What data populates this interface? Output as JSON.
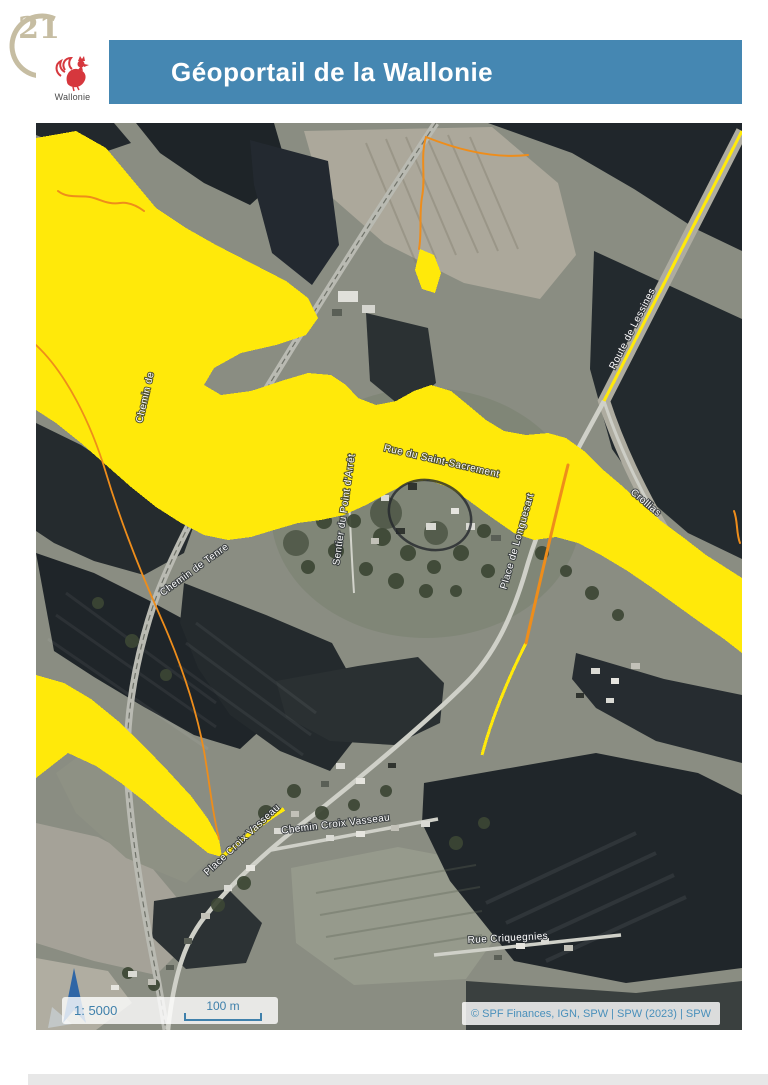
{
  "page": {
    "stamp_number": "21"
  },
  "header": {
    "title": "Géoportail de la Wallonie",
    "logo_text": "Wallonie"
  },
  "map": {
    "scale_text": "1: 5000",
    "scale_bar_label": "100 m",
    "attribution": "© SPF Finances, IGN, SPW | SPW (2023) | SPW",
    "street_labels": [
      {
        "text": "Route de Lessines",
        "x": 599,
        "y": 207,
        "rotate": -63
      },
      {
        "text": "Crollias",
        "x": 608,
        "y": 382,
        "rotate": 40
      },
      {
        "text": "Rue du Saint-Sacrement",
        "x": 405,
        "y": 341,
        "rotate": 13
      },
      {
        "text": "Sentier du Point d'Arrêt",
        "x": 311,
        "y": 387,
        "rotate": -82
      },
      {
        "text": "Chemin de Tenre",
        "x": 160,
        "y": 449,
        "rotate": -36
      },
      {
        "text": "Chemin de",
        "x": 112,
        "y": 275,
        "rotate": -77
      },
      {
        "text": "Place de Longuesart",
        "x": 484,
        "y": 419,
        "rotate": -74
      },
      {
        "text": "Place Croix Vasseau",
        "x": 208,
        "y": 719,
        "rotate": -43
      },
      {
        "text": "Chemin Croix Vasseau",
        "x": 300,
        "y": 704,
        "rotate": -7
      },
      {
        "text": "Rue Criquegnies",
        "x": 472,
        "y": 818,
        "rotate": -3
      }
    ],
    "colors": {
      "flood_zone_yellow": "#ffe90a",
      "stream_orange": "#ee8d1b",
      "header_blue": "#4587b2",
      "scale_text_blue": "#3f80ab",
      "north_arrow_blue": "#2f66a6",
      "stamp_tan": "#c6bda2",
      "rooster_red": "#d6373d"
    }
  }
}
